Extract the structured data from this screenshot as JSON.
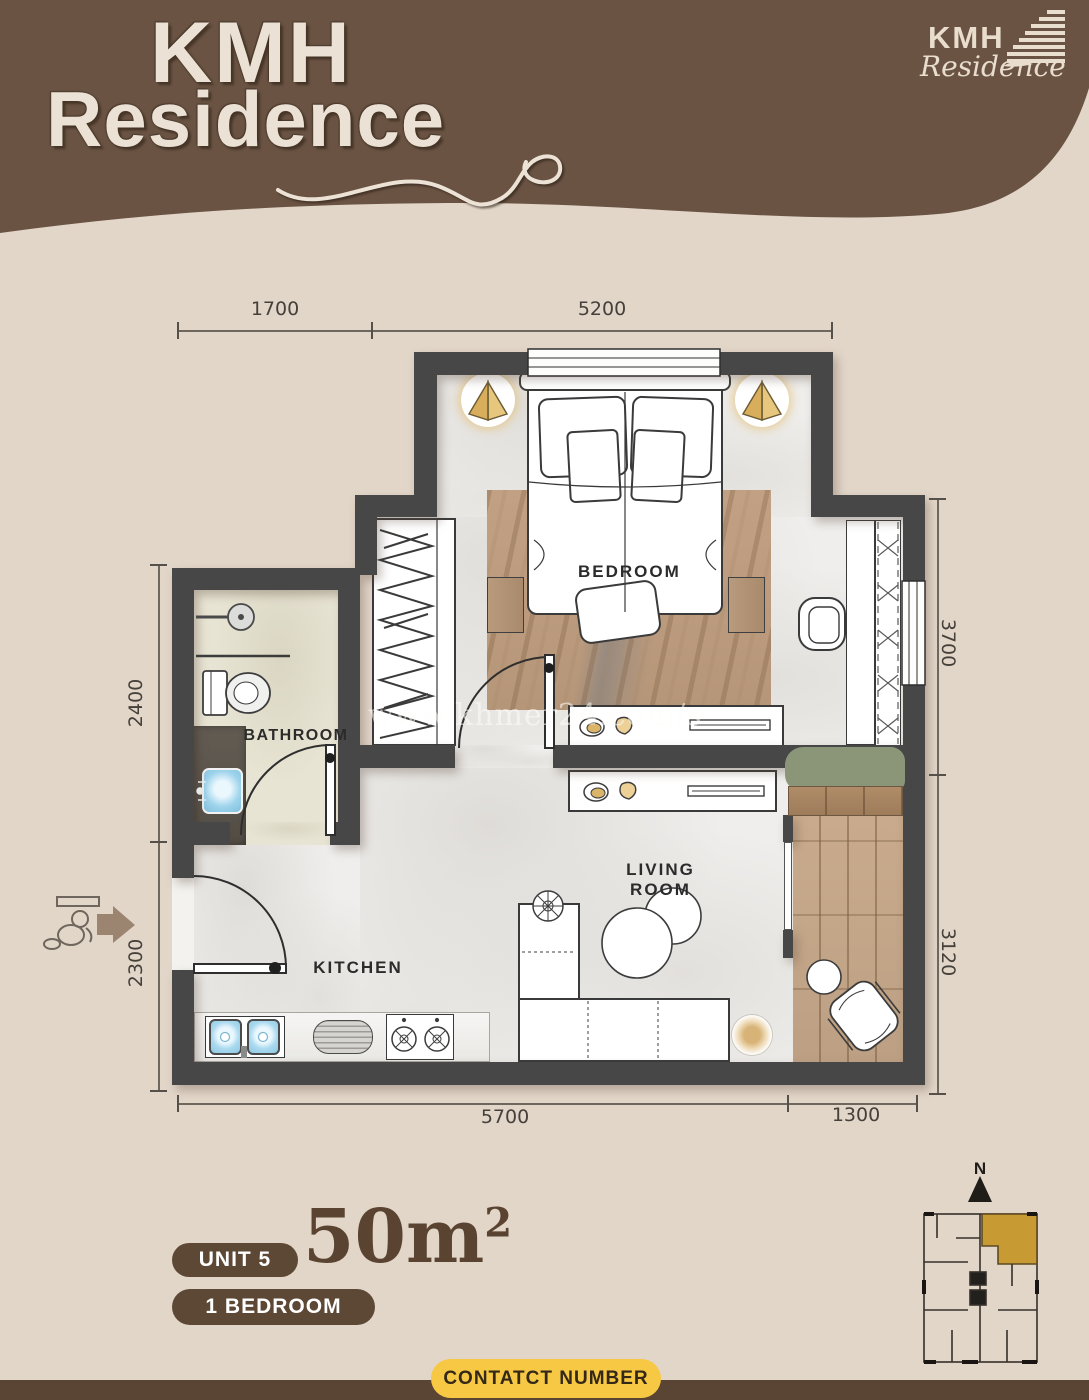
{
  "header": {
    "brand_line1": "KMH",
    "brand_line2": "Residence",
    "corner_logo": {
      "name": "KMH",
      "sub": "Residence"
    }
  },
  "watermark": {
    "text": "www.khmer24.com/s"
  },
  "plan": {
    "rooms": {
      "bedroom": "BEDROOM",
      "bathroom": "BATHROOM",
      "living": "LIVING ROOM",
      "kitchen": "KITCHEN"
    },
    "dimensions": {
      "top": [
        "1700",
        "5200"
      ],
      "left": [
        "2400",
        "2300"
      ],
      "right": [
        "3700",
        "3120"
      ],
      "bottom": [
        "5700",
        "1300"
      ]
    }
  },
  "compass": {
    "north": "N"
  },
  "footer": {
    "unit_label": "UNIT 5",
    "area_value": "50m",
    "area_superscript": "2",
    "type_label": "1 BEDROOM",
    "contact_label": "CONTATCT NUMBER"
  },
  "colors": {
    "header_brown": "#6a5343",
    "page_beige": "#e2d6c9",
    "wall_gray": "#474747",
    "accent_gold": "#c79a33",
    "button_yellow": "#f6c843",
    "pill_brown": "#5d4836",
    "bottom_bar_brown": "#5a4534"
  }
}
